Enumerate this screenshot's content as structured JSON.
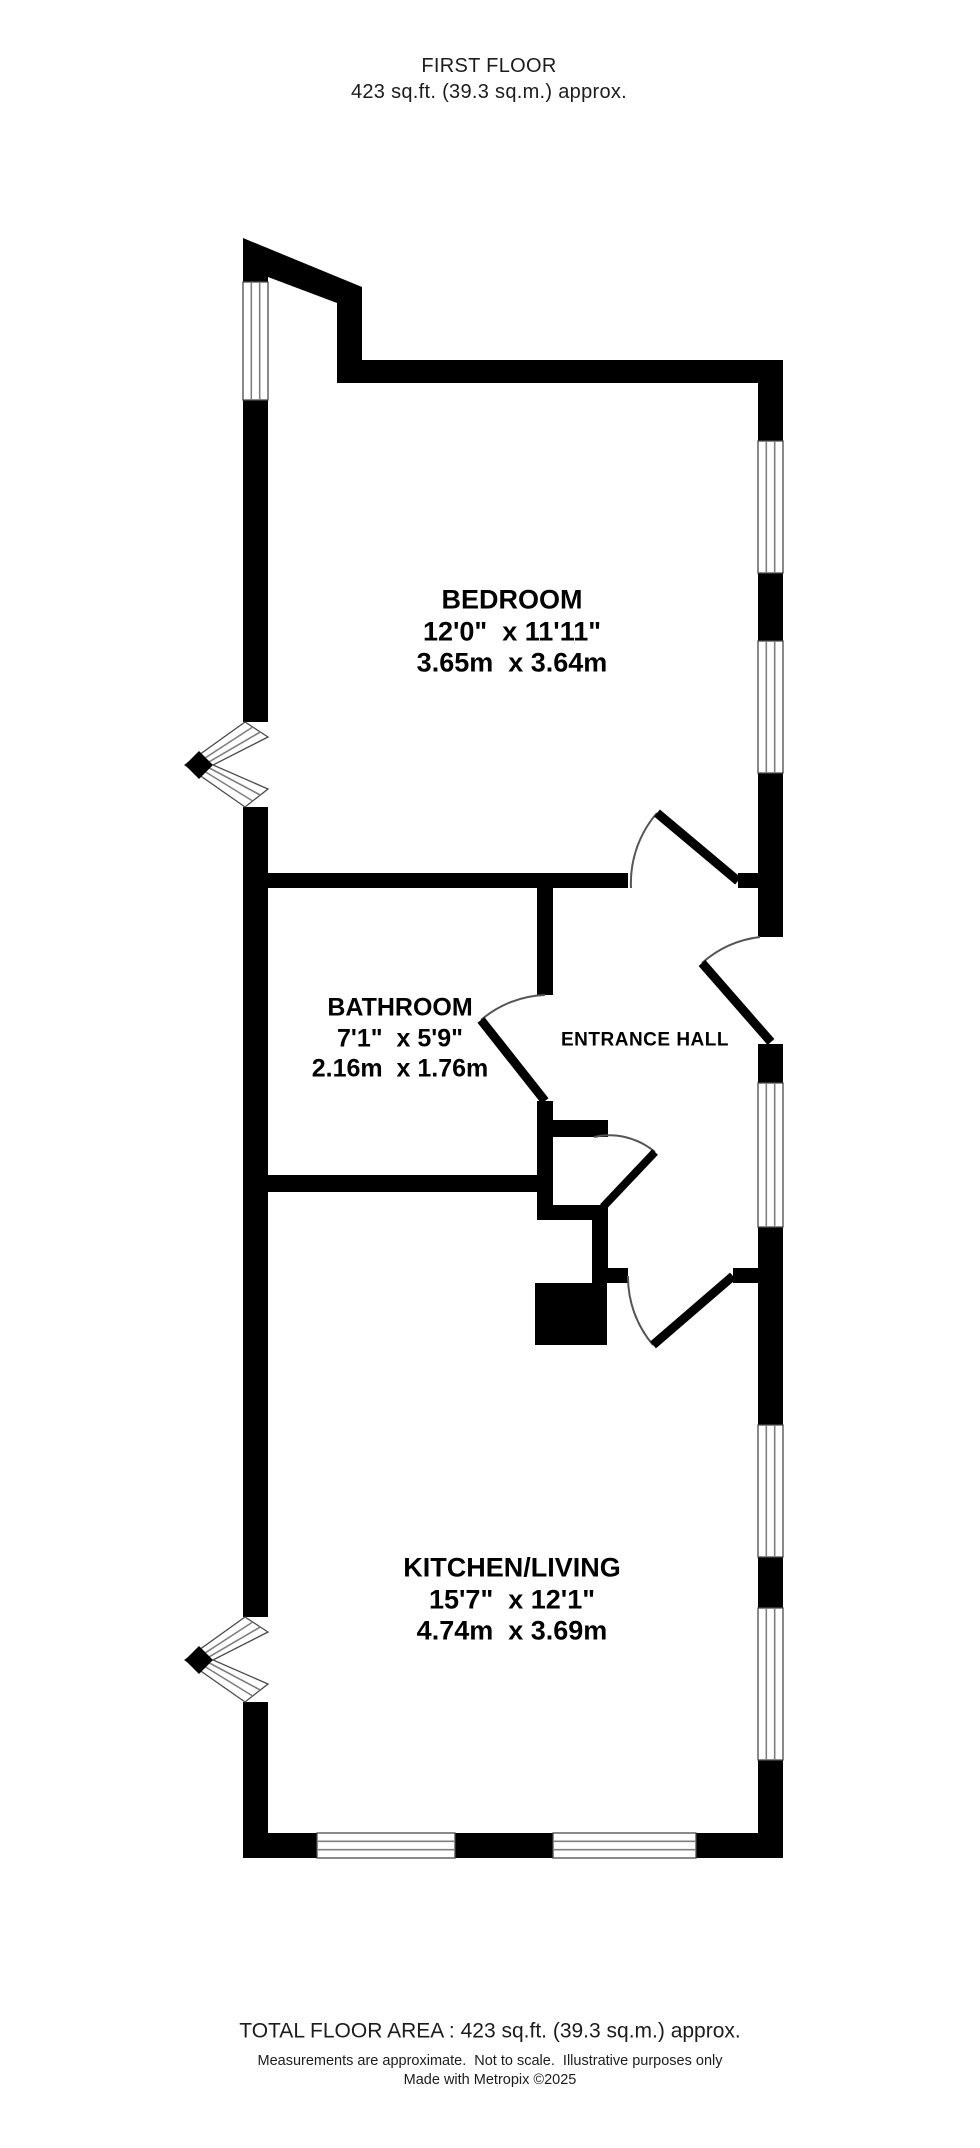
{
  "header": {
    "floor_title": "FIRST FLOOR",
    "floor_area": "423 sq.ft. (39.3 sq.m.) approx."
  },
  "rooms": [
    {
      "id": "bedroom",
      "name": "BEDROOM",
      "dims_imperial": "12'0\"  x 11'11\"",
      "dims_metric": "3.65m  x 3.64m"
    },
    {
      "id": "bathroom",
      "name": "BATHROOM",
      "dims_imperial": "7'1\"  x 5'9\"",
      "dims_metric": "2.16m  x 1.76m"
    },
    {
      "id": "entrance-hall",
      "name": "ENTRANCE HALL"
    },
    {
      "id": "kitchen-living",
      "name": "KITCHEN/LIVING",
      "dims_imperial": "15'7\"  x 12'1\"",
      "dims_metric": "4.74m  x 3.69m"
    }
  ],
  "footer": {
    "total_area": "TOTAL FLOOR AREA : 423 sq.ft. (39.3 sq.m.) approx.",
    "disclaimer": "Measurements are approximate.  Not to scale.  Illustrative purposes only",
    "credit": "Made with Metropix ©2025"
  },
  "colors": {
    "wall": "#000000",
    "background": "#ffffff",
    "window_frame": "#4a4a4a",
    "window_mullion": "#808080",
    "door_arc": "#555555",
    "text": "#111111"
  }
}
